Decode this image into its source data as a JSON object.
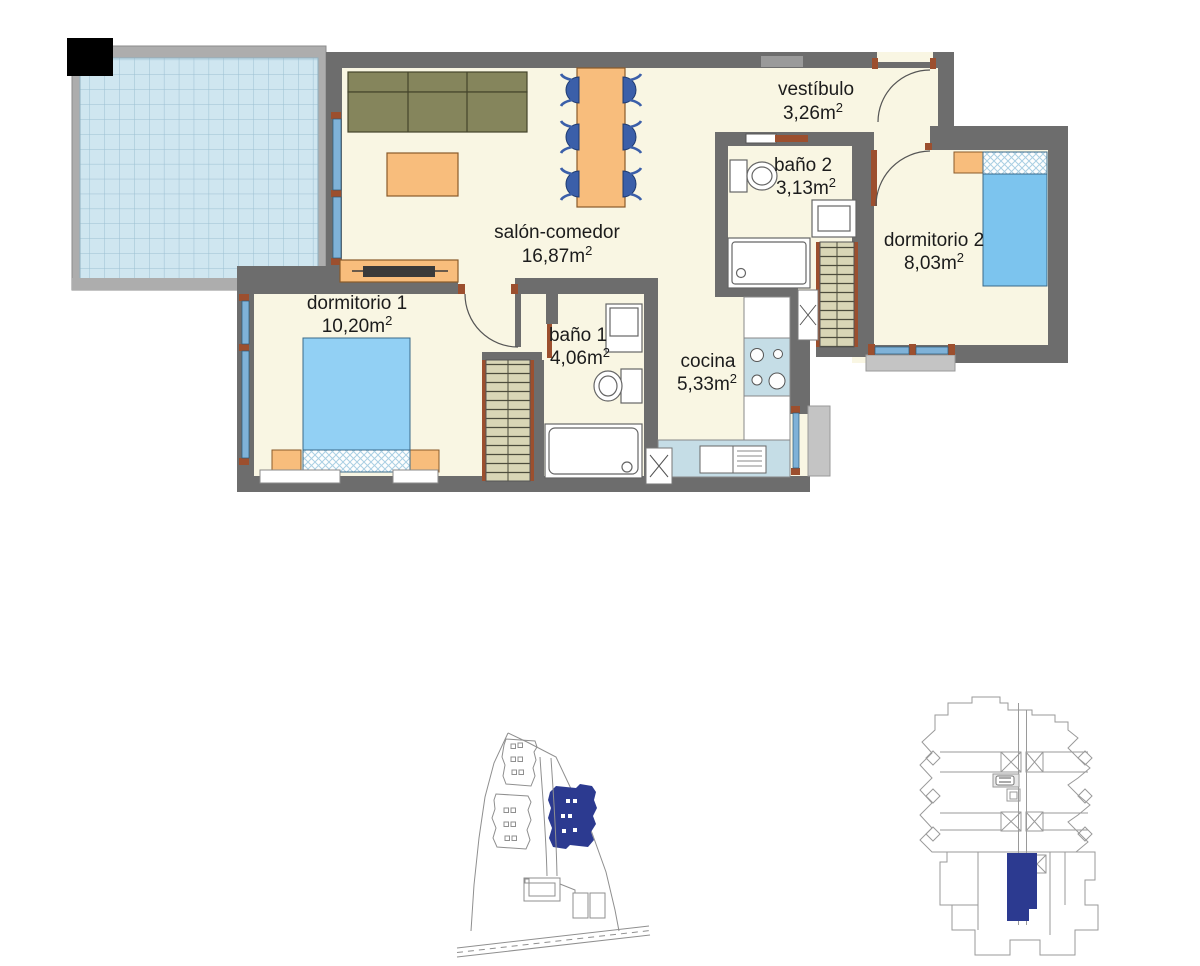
{
  "plan": {
    "type": "apartment-floor-plan",
    "rooms": [
      {
        "id": "salon",
        "name": "salón-comedor",
        "area": "16,87"
      },
      {
        "id": "vestibulo",
        "name": "vestíbulo",
        "area": "3,26"
      },
      {
        "id": "bano2",
        "name": "baño 2",
        "area": "3,13"
      },
      {
        "id": "dormitorio2",
        "name": "dormitorio 2",
        "area": "8,03"
      },
      {
        "id": "dormitorio1",
        "name": "dormitorio 1",
        "area": "10,20"
      },
      {
        "id": "bano1",
        "name": "baño 1",
        "area": "4,06"
      },
      {
        "id": "cocina",
        "name": "cocina",
        "area": "5,33"
      }
    ],
    "units": {
      "base": "m",
      "exp": "2"
    }
  },
  "colors": {
    "wall": "#6d6d6d",
    "floor": "#f9f6e3",
    "terrace_tile": "#cfe6f0",
    "terrace_frame": "#adadad",
    "bed_blue": "#8fd0f4",
    "furniture_orange": "#f8bd7c",
    "sofa_olive": "#85855c",
    "chair_blue": "#3b5fa9",
    "wardrobe_tan": "#d9d6b6",
    "counter_blue": "#c5dde6",
    "door_brown": "#9c4f2e",
    "window_blue": "#7fb2d8",
    "slab_gray": "#c4c4c4",
    "highlight_blue": "#2c3a90"
  }
}
